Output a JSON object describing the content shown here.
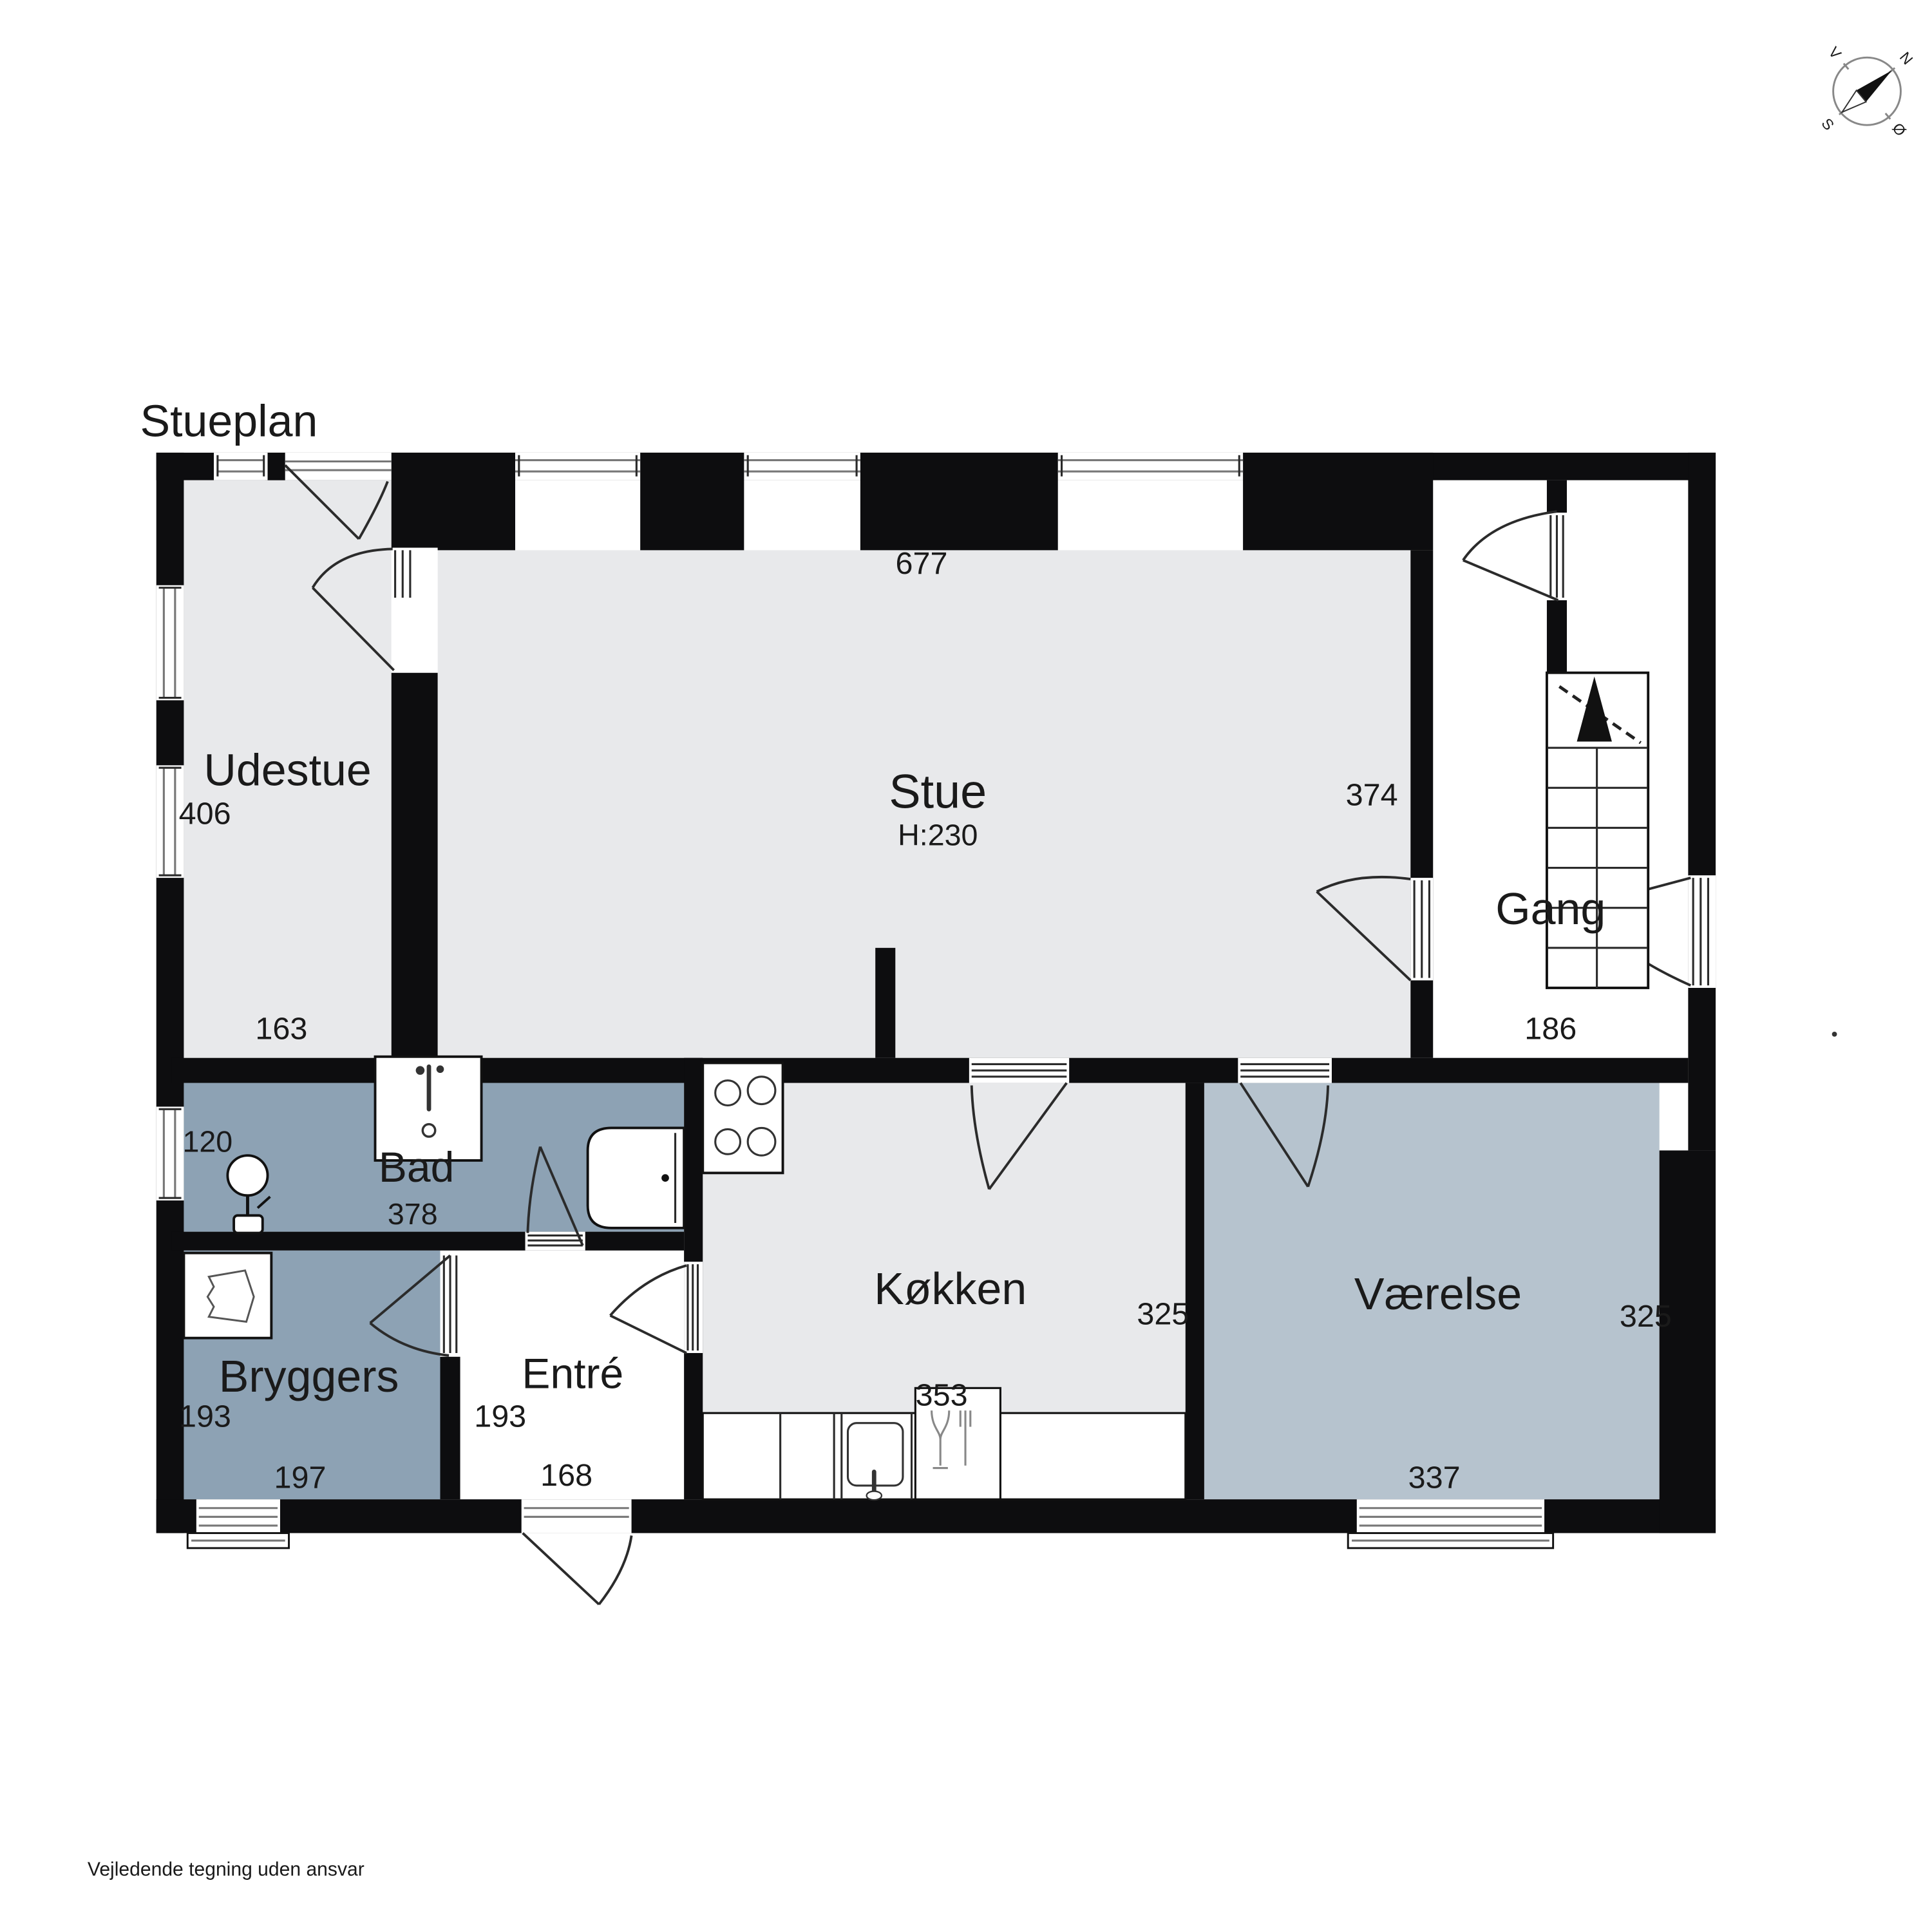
{
  "title": "Stueplan",
  "disclaimer": "Vejledende tegning uden ansvar",
  "compass": {
    "north": "N",
    "east": "Ø",
    "south": "S",
    "west": "V"
  },
  "colors": {
    "wall": "#0d0d0f",
    "room_light_gray": "#e8e9eb",
    "room_blue_gray": "#b6c3ce",
    "room_dark_blue_gray": "#8da2b4"
  },
  "rooms": {
    "udestue": {
      "name": "Udestue",
      "area": "406",
      "width_bottom": "163"
    },
    "stue": {
      "name": "Stue",
      "ceiling_height": "H:230",
      "width_top": "677",
      "width_right": "374"
    },
    "gang": {
      "name": "Gang",
      "width_bottom": "186"
    },
    "bad": {
      "name": "Bad",
      "width_bottom": "378",
      "window_left": "120"
    },
    "koekken": {
      "name": "Køkken",
      "depth_right": "325",
      "width_bottom": "353"
    },
    "vaerelse": {
      "name": "Værelse",
      "depth_right": "325",
      "width_bottom": "337"
    },
    "bryggers": {
      "name": "Bryggers",
      "depth_left": "193",
      "width_bottom": "197"
    },
    "entre": {
      "name": "Entré",
      "depth_left": "193",
      "width_bottom": "168"
    }
  }
}
